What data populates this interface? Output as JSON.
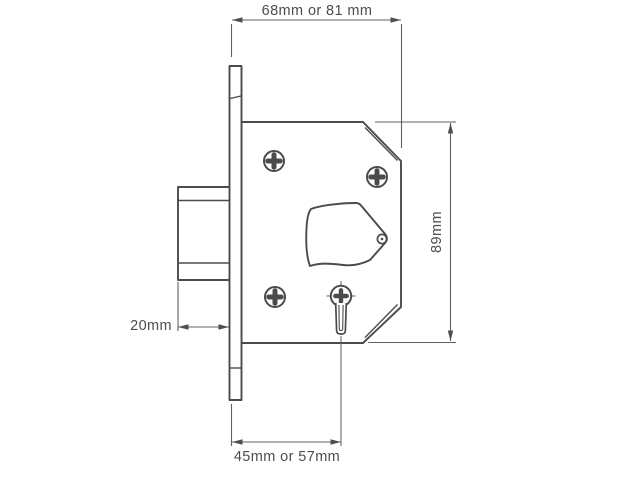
{
  "colors": {
    "background": "#ffffff",
    "outline": "#4b4b4b",
    "dimension_line": "#616161",
    "label_text": "#4d4d4d"
  },
  "dimensions": {
    "top_case_depth": "68mm or 81 mm",
    "right_case_height": "89mm",
    "left_bolt_throw": "20mm",
    "bottom_backset": "45mm or 57mm"
  }
}
